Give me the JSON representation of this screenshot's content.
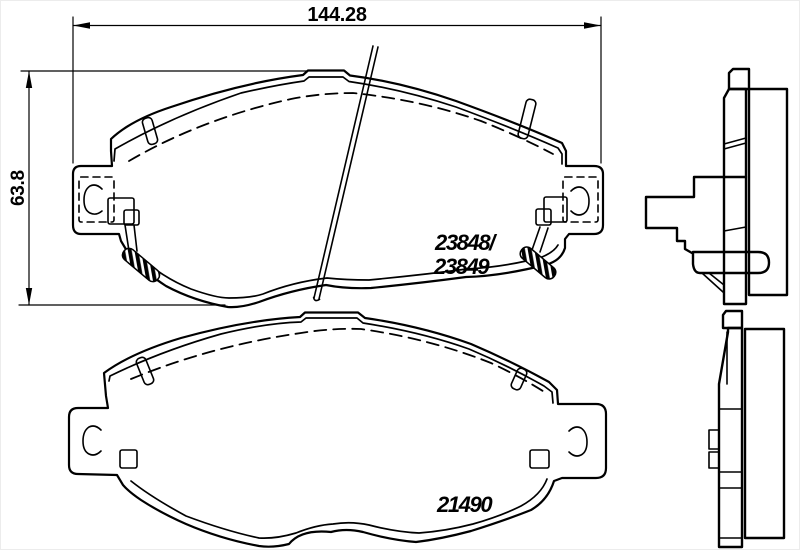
{
  "dimensions": {
    "width_mm": "144.28",
    "height_mm": "63.8"
  },
  "part_numbers": {
    "upper_pad_line1": "23848/",
    "upper_pad_line2": "23849",
    "lower_pad": "21490"
  },
  "colors": {
    "line": "#000000",
    "background": "#ffffff"
  }
}
